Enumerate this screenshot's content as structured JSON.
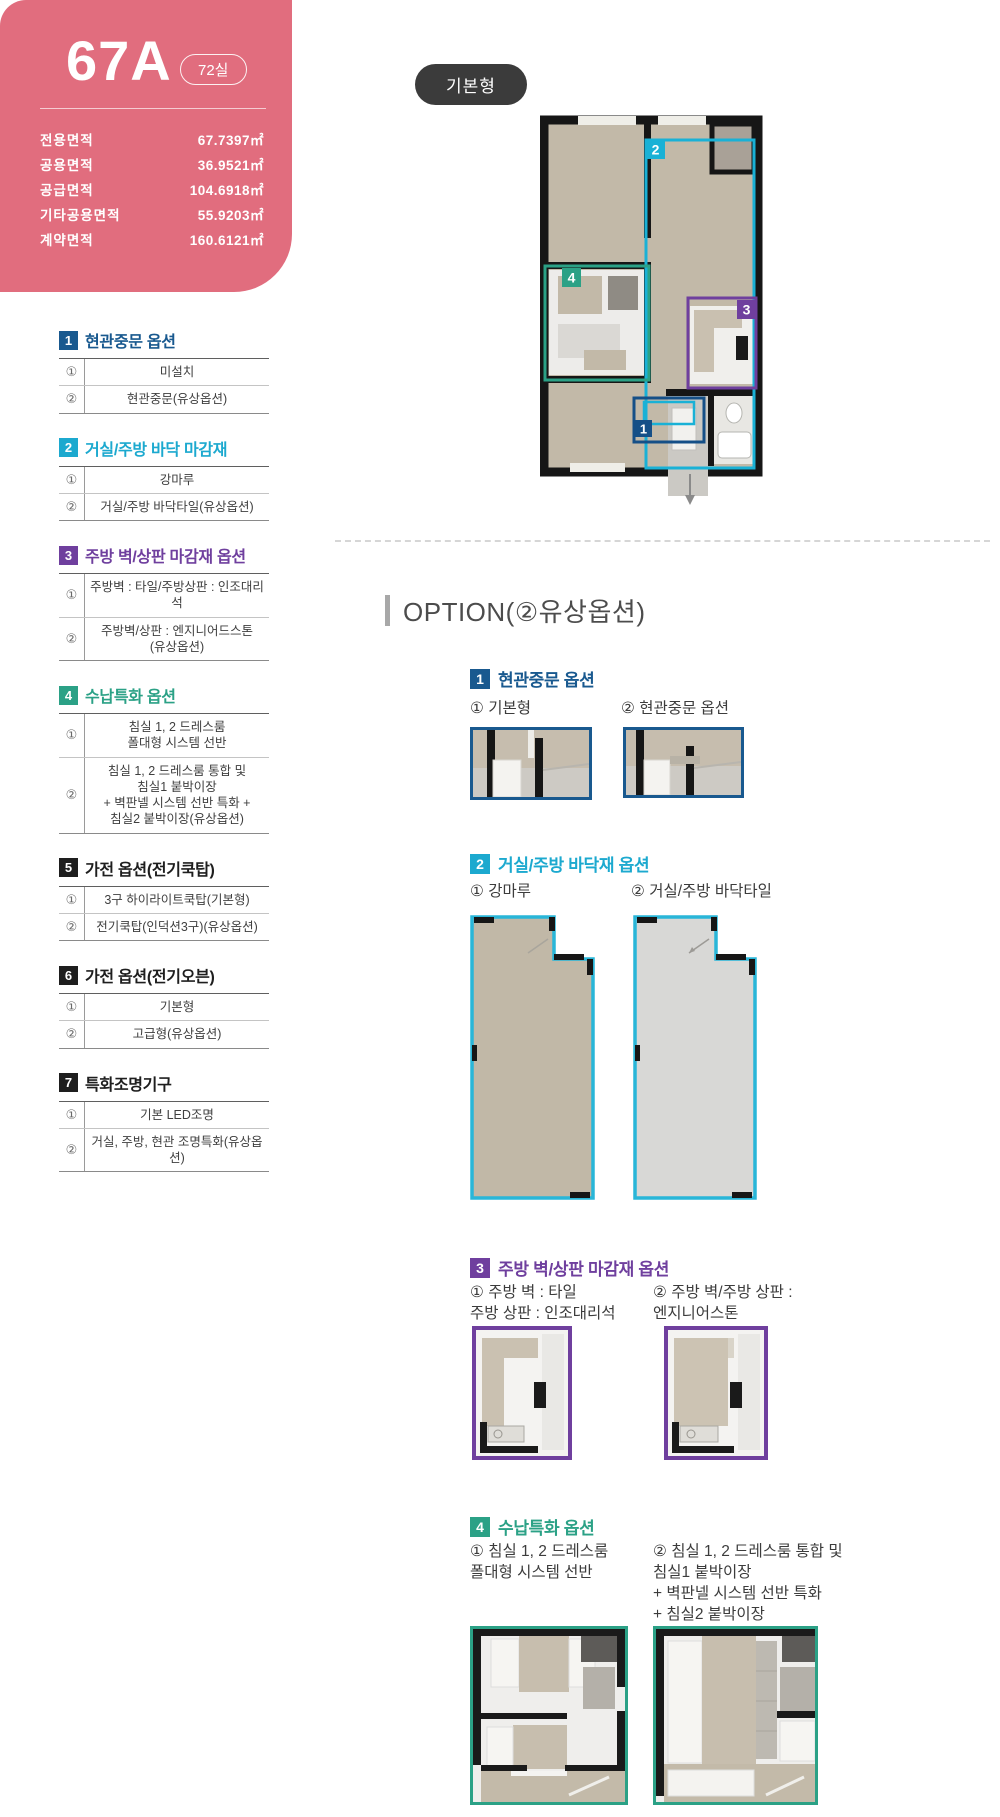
{
  "colors": {
    "card_pink": "#e16d7e",
    "navy": "#19598f",
    "cyan": "#1ca9cf",
    "purple": "#6f3f9e",
    "green": "#2ba186",
    "black": "#1e1e1e"
  },
  "unit_card": {
    "unit_type": "67A",
    "unit_count_badge": "72실",
    "areas": [
      {
        "label": "전용면적",
        "value": "67.7397㎡"
      },
      {
        "label": "공용면적",
        "value": "36.9521㎡"
      },
      {
        "label": "공급면적",
        "value": "104.6918㎡"
      },
      {
        "label": "기타공용면적",
        "value": "55.9203㎡"
      },
      {
        "label": "계약면적",
        "value": "160.6121㎡"
      }
    ]
  },
  "option_tables": [
    {
      "num": "1",
      "title": "현관중문 옵션",
      "color": "#19598f",
      "rows": [
        {
          "no": "①",
          "value": "미설치"
        },
        {
          "no": "②",
          "value": "현관중문(유상옵션)"
        }
      ]
    },
    {
      "num": "2",
      "title": "거실/주방 바닥 마감재",
      "color": "#1ca9cf",
      "rows": [
        {
          "no": "①",
          "value": "강마루"
        },
        {
          "no": "②",
          "value": "거실/주방 바닥타일(유상옵션)"
        }
      ]
    },
    {
      "num": "3",
      "title": "주방 벽/상판 마감재 옵션",
      "color": "#6f3f9e",
      "rows": [
        {
          "no": "①",
          "value": "주방벽 : 타일/주방상판 : 인조대리석"
        },
        {
          "no": "②",
          "value": "주방벽/상판 : 엔지니어드스톤\n(유상옵션)"
        }
      ]
    },
    {
      "num": "4",
      "title": "수납특화 옵션",
      "color": "#2ba186",
      "rows": [
        {
          "no": "①",
          "value": "침실 1, 2 드레스룸\n폴대형 시스템 선반"
        },
        {
          "no": "②",
          "value": "침실 1, 2 드레스룸 통합 및\n침실1 붙박이장\n+ 벽판넬 시스템 선반 특화 +\n침실2 붙박이장(유상옵션)"
        }
      ]
    },
    {
      "num": "5",
      "title": "가전 옵션(전기쿡탑)",
      "color": "#1e1e1e",
      "rows": [
        {
          "no": "①",
          "value": "3구 하이라이트쿡탑(기본형)"
        },
        {
          "no": "②",
          "value": "전기쿡탑(인덕션3구)(유상옵션)"
        }
      ]
    },
    {
      "num": "6",
      "title": "가전 옵션(전기오븐)",
      "color": "#1e1e1e",
      "rows": [
        {
          "no": "①",
          "value": "기본형"
        },
        {
          "no": "②",
          "value": "고급형(유상옵션)"
        }
      ]
    },
    {
      "num": "7",
      "title": "특화조명기구",
      "color": "#1e1e1e",
      "rows": [
        {
          "no": "①",
          "value": "기본 LED조명"
        },
        {
          "no": "②",
          "value": "거실, 주방, 현관 조명특화(유상옵션)"
        }
      ]
    }
  ],
  "plan": {
    "type_badge": "기본형",
    "markers": [
      "1",
      "2",
      "3",
      "4"
    ]
  },
  "option_section_heading": "OPTION(②유상옵션)",
  "option_sections": [
    {
      "num": "1",
      "title": "현관중문 옵션",
      "color": "#19598f",
      "items": [
        {
          "label": "① 기본형"
        },
        {
          "label": "② 현관중문 옵션"
        }
      ]
    },
    {
      "num": "2",
      "title": "거실/주방 바닥재 옵션",
      "color": "#1ca9cf",
      "items": [
        {
          "label": "① 강마루"
        },
        {
          "label": "② 거실/주방 바닥타일"
        }
      ]
    },
    {
      "num": "3",
      "title": "주방 벽/상판 마감재 옵션",
      "color": "#6f3f9e",
      "items": [
        {
          "label": "① 주방 벽 : 타일\n주방 상판 : 인조대리석"
        },
        {
          "label": "② 주방 벽/주방 상판 :\n엔지니어스톤"
        }
      ]
    },
    {
      "num": "4",
      "title": "수납특화 옵션",
      "color": "#2ba186",
      "items": [
        {
          "label": "① 침실 1, 2 드레스룸\n폴대형 시스템 선반"
        },
        {
          "label": "② 침실 1, 2 드레스룸 통합 및\n침실1 붙박이장\n+ 벽판넬 시스템 선반 특화\n+ 침실2 붙박이장"
        }
      ]
    }
  ]
}
